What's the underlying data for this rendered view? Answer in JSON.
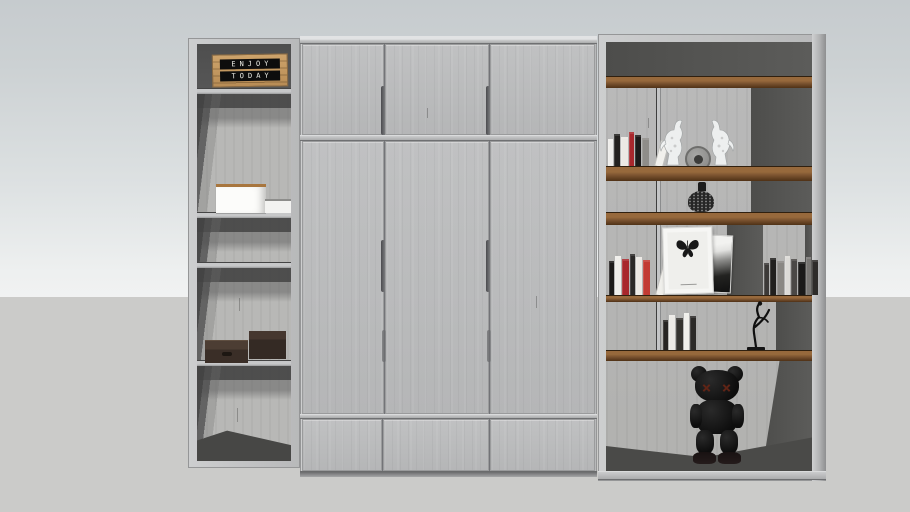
{
  "scene": {
    "description": "3D render of a wall-to-wall wardrobe with open shelving columns on a gray floor",
    "wall_top_color": "#c7ccce",
    "wall_bottom_color": "#f0f1f1",
    "floor_color": "#cbcbc9"
  },
  "palette": {
    "door_panel": "#bbbcbd",
    "frame": "#c4c5c6",
    "frame_edge": "#88898b",
    "interior_dark": "#545454",
    "back_panel": "#b6b6b4",
    "shelf_wood": "#8a5c33",
    "shelf_wood_dark": "#5d3c1e",
    "crate_wood": "#c59a63",
    "figure_black": "#141414",
    "figure_eye_red": "#5f2416",
    "accent_book_red": "#a8272c"
  },
  "left_column": {
    "sign": {
      "line1": "ENJOY",
      "line2": "TODAY"
    },
    "compartment_count": 5,
    "shelf_count": 4,
    "items": [
      "letter-board-sign",
      "white-box",
      "white-booklet",
      "storage-box-left",
      "storage-box-right"
    ]
  },
  "wardrobe": {
    "top_door_count": 3,
    "tall_door_count": 3,
    "drawer_count": 3
  },
  "right_column": {
    "row_count": 6,
    "rows": [
      {
        "label": "top-open",
        "items": []
      },
      {
        "label": "display",
        "items": [
          "books",
          "horse-figurines",
          "round-clock"
        ]
      },
      {
        "label": "vase",
        "items": [
          "speckled-vase"
        ]
      },
      {
        "label": "gallery",
        "items": [
          "books",
          "butterfly-frame",
          "abstract-print",
          "books"
        ]
      },
      {
        "label": "sculpture",
        "items": [
          "book-stack",
          "dancer-sculpture"
        ]
      },
      {
        "label": "bottom-open",
        "items": [
          "black-companion-figure"
        ]
      }
    ],
    "books": {
      "display_left": {
        "base_h": 30,
        "spines": [
          "#efeeeb",
          "#23211f",
          "#ece9e4",
          "#a8272c",
          "#1c1a19",
          "#8f8d89",
          "#f1f0ec"
        ],
        "lean_last": true
      },
      "gallery_left": {
        "base_h": 37,
        "spines": [
          "#1d1b1a",
          "#efeeea",
          "#a8272c",
          "#2b2928",
          "#ece9e4",
          "#c23b33",
          "#f0efeb"
        ],
        "lean_last": true
      },
      "gallery_right": {
        "base_h": 35,
        "spines": [
          "#3c3a38",
          "#21201e",
          "#8a8884",
          "#dcdbd7",
          "#4a4846",
          "#1b1a19",
          "#777572",
          "#2e2c2a"
        ],
        "lean_last": false
      },
      "sculpture_left": {
        "base_h": 33,
        "spines": [
          "#262422",
          "#eceae6",
          "#35332f",
          "#f0efeb",
          "#2c2a28"
        ],
        "lean_last": false
      }
    }
  }
}
